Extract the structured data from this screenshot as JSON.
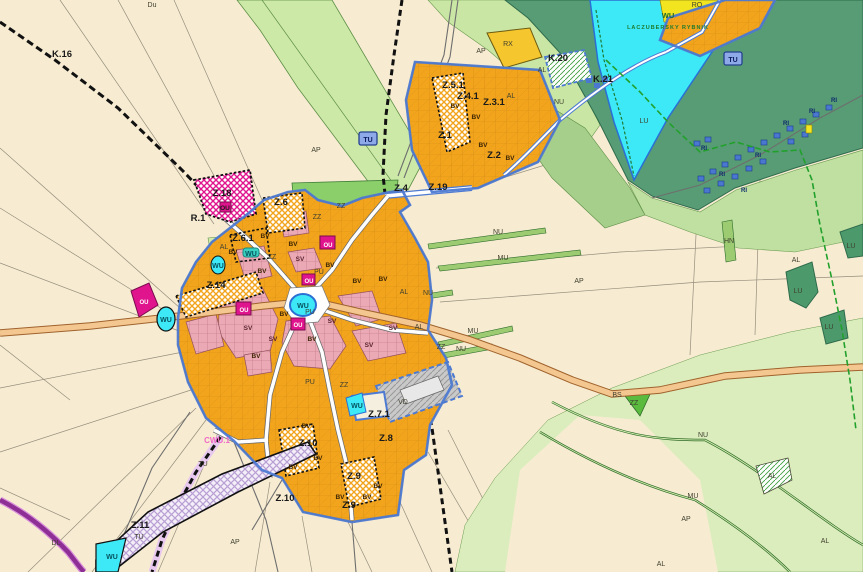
{
  "map": {
    "title": "Municipal zoning plan map",
    "lake": {
      "code": "WU",
      "name": "LACZUBERSKY RYBNIK"
    },
    "colors": {
      "agricultural_cream": "#f7ecd2",
      "meadow_light_green": "#d9ecbb",
      "forest_dark_green": "#579c74",
      "zz_green": "#8bcf6b",
      "water_cyan": "#3de9f7",
      "residential_orange": "#f2a41c",
      "mixed_pink": "#eaa9b5",
      "civic_magenta": "#e0148c",
      "boundary_blue": "#4d7ad2",
      "main_road_tan": "#f3c78f",
      "purple_road": "#8e2f96",
      "railway_black": "#111111",
      "trail_green": "#22a02c",
      "ri_blue": "#4a77cf",
      "rx_yellow": "#f6c62e",
      "vd_gray": "#c9c9c9"
    },
    "badges": [
      {
        "t": "TU",
        "x": 368,
        "y": 139
      },
      {
        "t": "TU",
        "x": 733,
        "y": 59
      }
    ],
    "labels": [
      {
        "t": "K.16",
        "x": 62,
        "y": 57,
        "k": "zone"
      },
      {
        "t": "R.1",
        "x": 198,
        "y": 221,
        "k": "zone"
      },
      {
        "t": "Z.18",
        "x": 222,
        "y": 196,
        "k": "zone"
      },
      {
        "t": "Z.6",
        "x": 281,
        "y": 205,
        "k": "zone"
      },
      {
        "t": "Z.6.1",
        "x": 243,
        "y": 241,
        "k": "zone"
      },
      {
        "t": "Z.14",
        "x": 216,
        "y": 288,
        "k": "zone"
      },
      {
        "t": "Z.2",
        "x": 494,
        "y": 158,
        "k": "zone"
      },
      {
        "t": "Z.4",
        "x": 401,
        "y": 191,
        "k": "zone"
      },
      {
        "t": "Z.19",
        "x": 438,
        "y": 190,
        "k": "zone"
      },
      {
        "t": "Z.1",
        "x": 445,
        "y": 138,
        "k": "zone"
      },
      {
        "t": "Z.5.1",
        "x": 453,
        "y": 88,
        "k": "zone"
      },
      {
        "t": "Z.4.1",
        "x": 468,
        "y": 99,
        "k": "zone"
      },
      {
        "t": "Z.3.1",
        "x": 494,
        "y": 105,
        "k": "zone"
      },
      {
        "t": "K.20",
        "x": 558,
        "y": 61,
        "k": "zone"
      },
      {
        "t": "K.21",
        "x": 603,
        "y": 82,
        "k": "zone"
      },
      {
        "t": "Z.7.1",
        "x": 379,
        "y": 417,
        "k": "zone"
      },
      {
        "t": "Z.8",
        "x": 386,
        "y": 441,
        "k": "zone"
      },
      {
        "t": "Z.9",
        "x": 354,
        "y": 479,
        "k": "zone"
      },
      {
        "t": "Z.9",
        "x": 349,
        "y": 508,
        "k": "zone"
      },
      {
        "t": "Z.10",
        "x": 308,
        "y": 446,
        "k": "zone"
      },
      {
        "t": "Z.10",
        "x": 285,
        "y": 501,
        "k": "zone"
      },
      {
        "t": "Z.11",
        "x": 140,
        "y": 528,
        "k": "zone"
      },
      {
        "t": "AP",
        "x": 316,
        "y": 152,
        "k": "area"
      },
      {
        "t": "AP",
        "x": 481,
        "y": 53,
        "k": "area"
      },
      {
        "t": "AP",
        "x": 579,
        "y": 283,
        "k": "area"
      },
      {
        "t": "AP",
        "x": 686,
        "y": 521,
        "k": "area"
      },
      {
        "t": "AP",
        "x": 235,
        "y": 544,
        "k": "area"
      },
      {
        "t": "AL",
        "x": 542,
        "y": 72,
        "k": "area"
      },
      {
        "t": "AL",
        "x": 511,
        "y": 98,
        "k": "area"
      },
      {
        "t": "AL",
        "x": 404,
        "y": 294,
        "k": "area"
      },
      {
        "t": "AL",
        "x": 419,
        "y": 329,
        "k": "area"
      },
      {
        "t": "AL",
        "x": 224,
        "y": 249,
        "k": "area"
      },
      {
        "t": "AL",
        "x": 661,
        "y": 566,
        "k": "area"
      },
      {
        "t": "AL",
        "x": 825,
        "y": 543,
        "k": "area"
      },
      {
        "t": "AL",
        "x": 772,
        "y": 478,
        "k": "area"
      },
      {
        "t": "AL",
        "x": 796,
        "y": 262,
        "k": "area"
      },
      {
        "t": "NU",
        "x": 559,
        "y": 104,
        "k": "area"
      },
      {
        "t": "NU",
        "x": 498,
        "y": 234,
        "k": "area"
      },
      {
        "t": "NU",
        "x": 428,
        "y": 295,
        "k": "area"
      },
      {
        "t": "NU",
        "x": 461,
        "y": 351,
        "k": "area"
      },
      {
        "t": "NU",
        "x": 703,
        "y": 437,
        "k": "area"
      },
      {
        "t": "MU",
        "x": 503,
        "y": 260,
        "k": "area"
      },
      {
        "t": "MU",
        "x": 473,
        "y": 333,
        "k": "area"
      },
      {
        "t": "MU",
        "x": 693,
        "y": 498,
        "k": "area"
      },
      {
        "t": "HN",
        "x": 729,
        "y": 243,
        "k": "area"
      },
      {
        "t": "BS",
        "x": 617,
        "y": 397,
        "k": "area"
      },
      {
        "t": "ZZ",
        "x": 341,
        "y": 208,
        "k": "area"
      },
      {
        "t": "ZZ",
        "x": 272,
        "y": 259,
        "k": "area"
      },
      {
        "t": "ZZ",
        "x": 317,
        "y": 219,
        "k": "area"
      },
      {
        "t": "ZZ",
        "x": 344,
        "y": 387,
        "k": "area"
      },
      {
        "t": "ZZ",
        "x": 634,
        "y": 405,
        "k": "area"
      },
      {
        "t": "ZZ",
        "x": 441,
        "y": 349,
        "k": "area"
      },
      {
        "t": "Du",
        "x": 152,
        "y": 7,
        "k": "area"
      },
      {
        "t": "RO",
        "x": 697,
        "y": 7,
        "k": "area"
      },
      {
        "t": "RX",
        "x": 508,
        "y": 46,
        "k": "area"
      },
      {
        "t": "LU",
        "x": 644,
        "y": 123,
        "k": "area"
      },
      {
        "t": "LU",
        "x": 851,
        "y": 248,
        "k": "area"
      },
      {
        "t": "LU",
        "x": 798,
        "y": 293,
        "k": "area"
      },
      {
        "t": "LU",
        "x": 829,
        "y": 329,
        "k": "area"
      },
      {
        "t": "PU",
        "x": 319,
        "y": 274,
        "k": "area"
      },
      {
        "t": "PU",
        "x": 310,
        "y": 314,
        "k": "area"
      },
      {
        "t": "PU",
        "x": 310,
        "y": 384,
        "k": "area"
      },
      {
        "t": "VD",
        "x": 403,
        "y": 404,
        "k": "area"
      },
      {
        "t": "TU",
        "x": 139,
        "y": 539,
        "k": "area"
      },
      {
        "t": "TU",
        "x": 203,
        "y": 466,
        "k": "area"
      },
      {
        "t": "DL",
        "x": 56,
        "y": 545,
        "k": "area"
      },
      {
        "t": "BV",
        "x": 265,
        "y": 238,
        "k": "bv"
      },
      {
        "t": "BV",
        "x": 293,
        "y": 246,
        "k": "bv"
      },
      {
        "t": "BV",
        "x": 233,
        "y": 254,
        "k": "bv"
      },
      {
        "t": "BV",
        "x": 262,
        "y": 273,
        "k": "bv"
      },
      {
        "t": "BV",
        "x": 330,
        "y": 267,
        "k": "bv"
      },
      {
        "t": "BV",
        "x": 357,
        "y": 283,
        "k": "bv"
      },
      {
        "t": "BV",
        "x": 383,
        "y": 281,
        "k": "bv"
      },
      {
        "t": "BV",
        "x": 284,
        "y": 316,
        "k": "bv"
      },
      {
        "t": "BV",
        "x": 312,
        "y": 341,
        "k": "bv"
      },
      {
        "t": "BV",
        "x": 256,
        "y": 358,
        "k": "bv"
      },
      {
        "t": "BV",
        "x": 306,
        "y": 428,
        "k": "bv"
      },
      {
        "t": "BV",
        "x": 318,
        "y": 460,
        "k": "bv"
      },
      {
        "t": "BV",
        "x": 293,
        "y": 469,
        "k": "bv"
      },
      {
        "t": "BV",
        "x": 340,
        "y": 499,
        "k": "bv"
      },
      {
        "t": "BV",
        "x": 367,
        "y": 499,
        "k": "bv"
      },
      {
        "t": "BV",
        "x": 378,
        "y": 488,
        "k": "bv"
      },
      {
        "t": "BV",
        "x": 455,
        "y": 108,
        "k": "bv"
      },
      {
        "t": "BV",
        "x": 476,
        "y": 119,
        "k": "bv"
      },
      {
        "t": "BV",
        "x": 483,
        "y": 147,
        "k": "bv"
      },
      {
        "t": "BV",
        "x": 510,
        "y": 160,
        "k": "bv"
      },
      {
        "t": "SV",
        "x": 300,
        "y": 261,
        "k": "sv"
      },
      {
        "t": "SV",
        "x": 273,
        "y": 341,
        "k": "sv"
      },
      {
        "t": "SV",
        "x": 332,
        "y": 323,
        "k": "sv"
      },
      {
        "t": "SV",
        "x": 369,
        "y": 347,
        "k": "sv"
      },
      {
        "t": "SV",
        "x": 248,
        "y": 330,
        "k": "sv"
      },
      {
        "t": "SV",
        "x": 393,
        "y": 330,
        "k": "sv"
      },
      {
        "t": "OU",
        "x": 328,
        "y": 247,
        "k": "oul"
      },
      {
        "t": "OU",
        "x": 244,
        "y": 312,
        "k": "oul"
      },
      {
        "t": "OU",
        "x": 298,
        "y": 327,
        "k": "oul"
      },
      {
        "t": "OU",
        "x": 309,
        "y": 283,
        "k": "oul"
      },
      {
        "t": "OU",
        "x": 144,
        "y": 304,
        "k": "oul"
      },
      {
        "t": "OU",
        "x": 225,
        "y": 210,
        "k": "oud"
      },
      {
        "t": "WU",
        "x": 303,
        "y": 308,
        "k": "wu"
      },
      {
        "t": "WU",
        "x": 166,
        "y": 322,
        "k": "wu"
      },
      {
        "t": "WU",
        "x": 218,
        "y": 268,
        "k": "wu"
      },
      {
        "t": "WU",
        "x": 357,
        "y": 408,
        "k": "wu"
      },
      {
        "t": "WU",
        "x": 112,
        "y": 559,
        "k": "wu"
      },
      {
        "t": "WU",
        "x": 251,
        "y": 256,
        "k": "wu"
      },
      {
        "t": "WU",
        "x": 668,
        "y": 18,
        "k": "grn"
      },
      {
        "t": "LACZUBERSKY RYBNIK",
        "x": 668,
        "y": 29,
        "k": "wus"
      },
      {
        "t": "RI",
        "x": 704,
        "y": 150,
        "k": "ri"
      },
      {
        "t": "RI",
        "x": 722,
        "y": 176,
        "k": "ri"
      },
      {
        "t": "RI",
        "x": 744,
        "y": 192,
        "k": "ri"
      },
      {
        "t": "RI",
        "x": 758,
        "y": 157,
        "k": "ri"
      },
      {
        "t": "RI",
        "x": 786,
        "y": 125,
        "k": "ri"
      },
      {
        "t": "RI",
        "x": 812,
        "y": 113,
        "k": "ri"
      },
      {
        "t": "RI",
        "x": 834,
        "y": 102,
        "k": "ri"
      },
      {
        "t": "CWU.1",
        "x": 217,
        "y": 443,
        "k": "pink"
      }
    ]
  }
}
